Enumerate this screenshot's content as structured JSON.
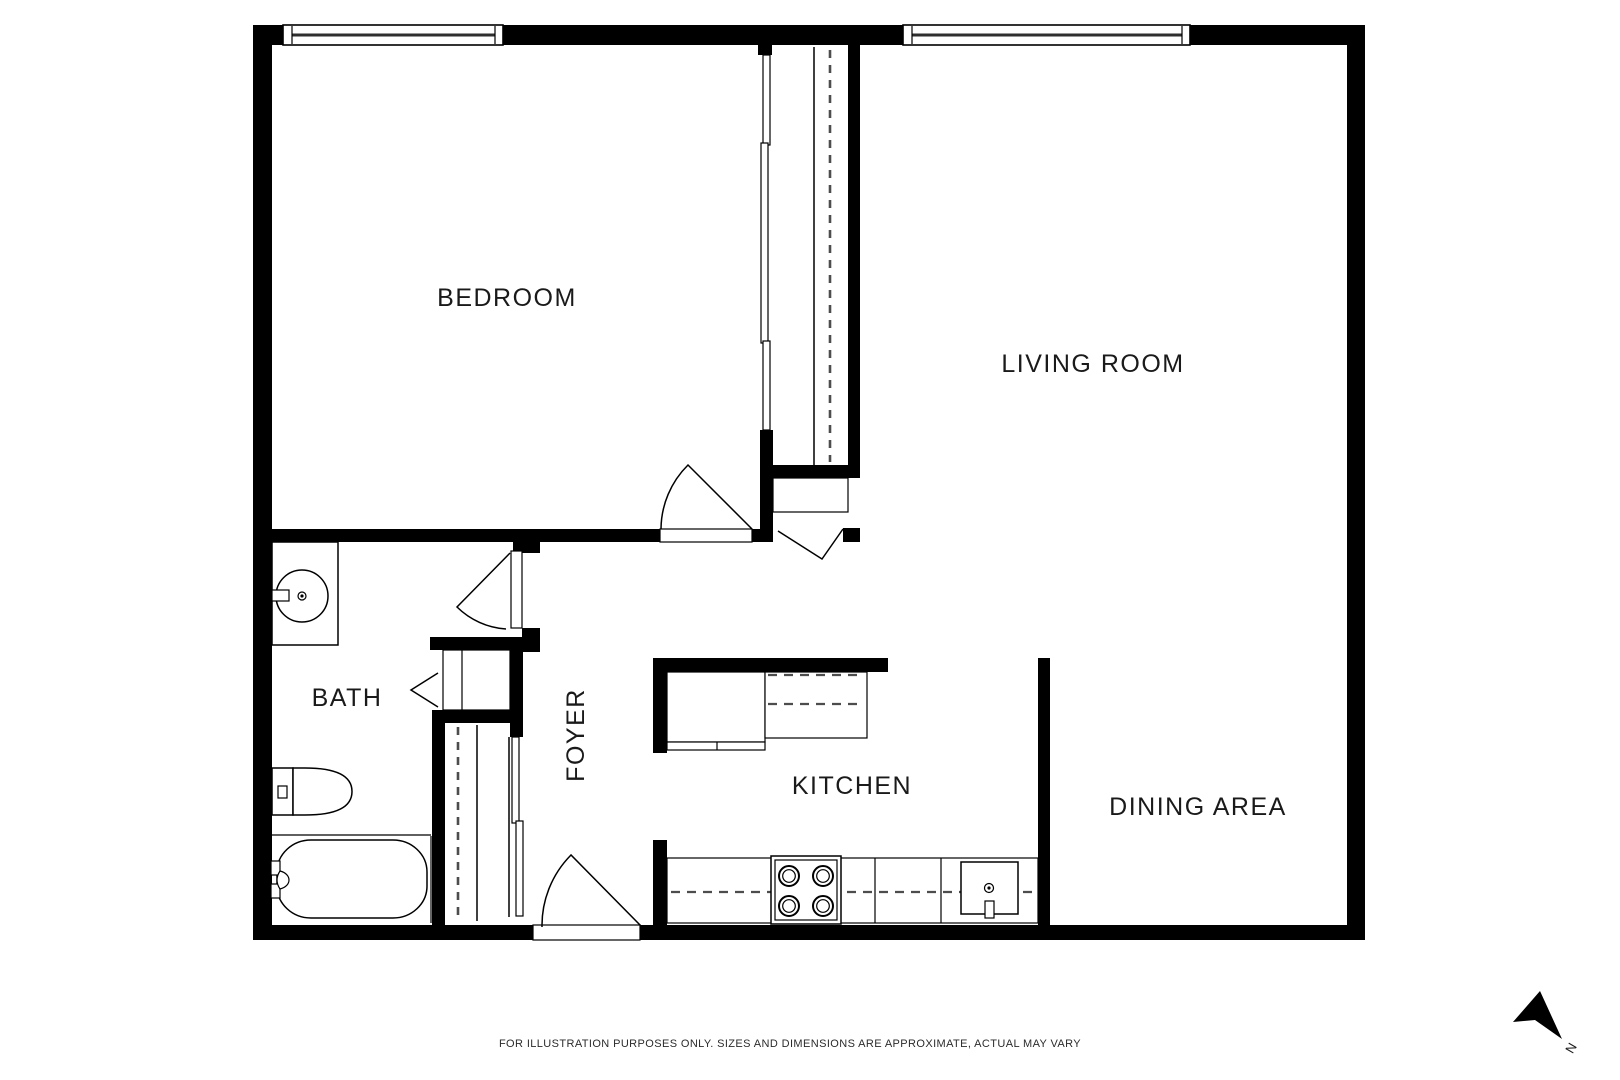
{
  "title": "Apartment floor plan",
  "rooms": {
    "bedroom": {
      "label": "BEDROOM"
    },
    "living_room": {
      "label": "LIVING ROOM"
    },
    "bath": {
      "label": "BATH"
    },
    "foyer": {
      "label": "FOYER"
    },
    "kitchen": {
      "label": "KITCHEN"
    },
    "dining": {
      "label": "DINING AREA"
    }
  },
  "compass": {
    "label": "N"
  },
  "footer": {
    "disclaimer": "FOR ILLUSTRATION PURPOSES ONLY. SIZES AND DIMENSIONS ARE APPROXIMATE, ACTUAL MAY VARY"
  },
  "fixtures": [
    "bathroom-vanity-sink",
    "toilet",
    "bathtub",
    "linen-closet",
    "foyer-closet",
    "bedroom-closet",
    "range-stove",
    "kitchen-sink",
    "kitchen-counter",
    "upper-cabinets",
    "window",
    "door-swing",
    "bifold-door",
    "north-arrow"
  ],
  "colors": {
    "wall": "#000000",
    "background": "#ffffff",
    "text": "#1a1a1a",
    "dashed": "#4d4d4d"
  }
}
